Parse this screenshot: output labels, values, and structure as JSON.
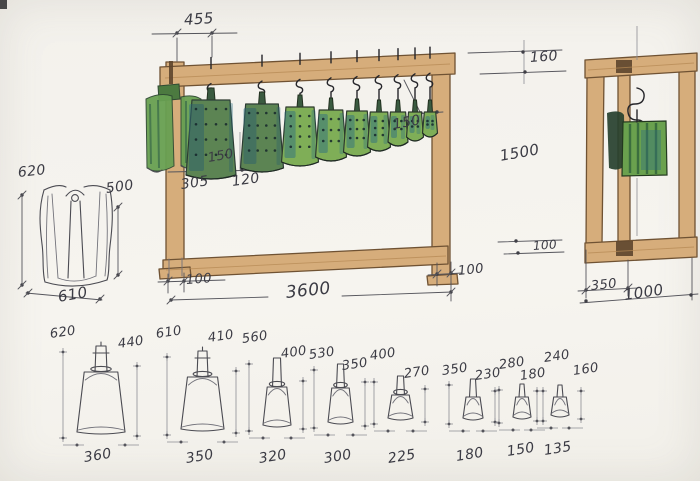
{
  "front_view": {
    "dim_top_offset": "455",
    "dim_bell_spacing": "150",
    "dim_spacing_left": "305",
    "dim_spacing_mid": "120",
    "dim_right_gap": "150",
    "dim_top_rail_height": "160",
    "dim_frame_height": "1500",
    "dim_bottom_rail_height": "100",
    "dim_post_offset_left": "100",
    "dim_total_width": "3600",
    "dim_post_offset_right": "100"
  },
  "side_view": {
    "dim_inner_post_offset": "350",
    "dim_total_depth": "1000"
  },
  "garment_detail": {
    "dim_height_left": "620",
    "dim_height_right": "500",
    "dim_width": "610"
  },
  "bells": [
    {
      "total_height": "620",
      "body_height": "440",
      "mouth_width": "360"
    },
    {
      "total_height": "610",
      "body_height": "410",
      "mouth_width": "350"
    },
    {
      "total_height": "560",
      "body_height": "400",
      "mouth_width": "320"
    },
    {
      "total_height": "530",
      "body_height": "350",
      "mouth_width": "300"
    },
    {
      "total_height": "400",
      "body_height": "270",
      "mouth_width": "225"
    },
    {
      "total_height": "350",
      "body_height": "230",
      "mouth_width": "180"
    },
    {
      "total_height": "280",
      "body_height": "180",
      "mouth_width": "150"
    },
    {
      "total_height": "240",
      "body_height": "160",
      "mouth_width": "135"
    }
  ],
  "colors": {
    "paper": "#f4f2ee",
    "wood": "#d6ad7b",
    "bell_green": "#7fae57",
    "bell_teal": "#2f6f80",
    "pencil": "#4b4b52"
  }
}
